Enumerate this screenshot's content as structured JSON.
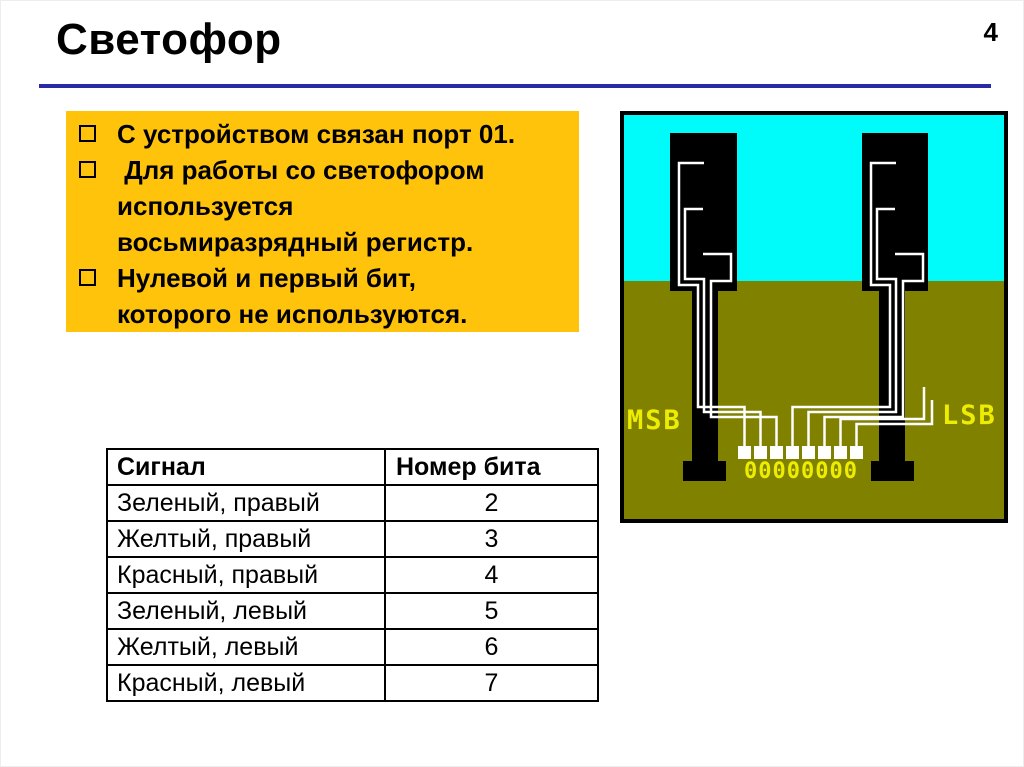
{
  "slide": {
    "title": "Светофор",
    "page_number": "4"
  },
  "info_box": {
    "items": [
      "С устройством связан порт 01.",
      " Для работы со светофором\nиспользуется\nвосьмиразрядный регистр.",
      "Нулевой и первый бит,\nкоторого не используются."
    ]
  },
  "signal_table": {
    "headers": [
      "Сигнал",
      "Номер бита"
    ],
    "rows": [
      [
        "Зеленый, правый",
        "2"
      ],
      [
        "Желтый, правый",
        "3"
      ],
      [
        "Красный, правый",
        "4"
      ],
      [
        "Зеленый, левый",
        "5"
      ],
      [
        "Желтый, левый",
        "6"
      ],
      [
        "Красный, левый",
        "7"
      ]
    ]
  },
  "diagram": {
    "msb_label": "MSB",
    "lsb_label": "LSB",
    "register_bits": "00000000",
    "colors": {
      "sky": "#00FBFB",
      "ground": "#818100",
      "label": "#EDED04",
      "housing": "#000000",
      "wire": "#FFFFFF"
    }
  },
  "colors": {
    "accent_line": "#2A2AA4",
    "info_box_bg": "#FFC30B"
  }
}
